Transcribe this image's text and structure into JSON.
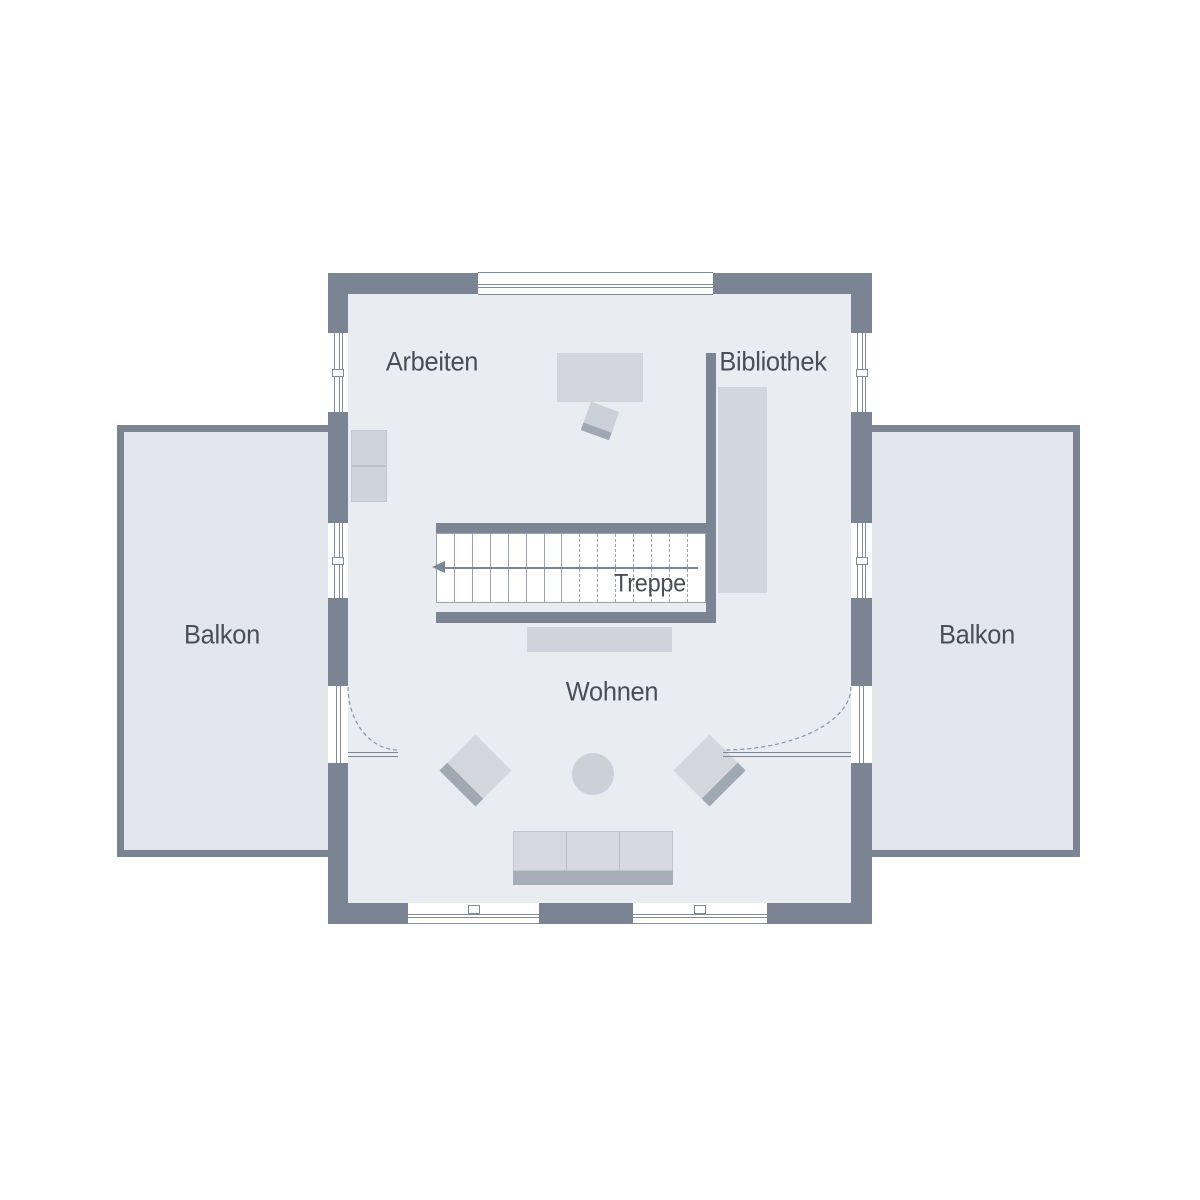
{
  "rooms": {
    "arbeiten": {
      "label": "Arbeiten"
    },
    "bibliothek": {
      "label": "Bibliothek"
    },
    "treppe": {
      "label": "Treppe"
    },
    "wohnen": {
      "label": "Wohnen"
    },
    "balkon_left": {
      "label": "Balkon"
    },
    "balkon_right": {
      "label": "Balkon"
    }
  },
  "colors": {
    "wall": "#7a8492",
    "room_floor": "#e9ecf1",
    "balcony_floor": "#e3e7ed",
    "furniture_light": "#d2d6dd",
    "furniture_mid": "#ccd0d8",
    "furniture_dark": "#a6adb8",
    "stair_line": "#9aa3af",
    "text": "#4a4f57",
    "background": "#ffffff"
  },
  "stairs": {
    "solid_offsets": [
      17,
      35,
      53,
      71,
      89,
      107,
      124
    ],
    "dashed_offsets": [
      142,
      160,
      178,
      196,
      214,
      232,
      250
    ]
  }
}
